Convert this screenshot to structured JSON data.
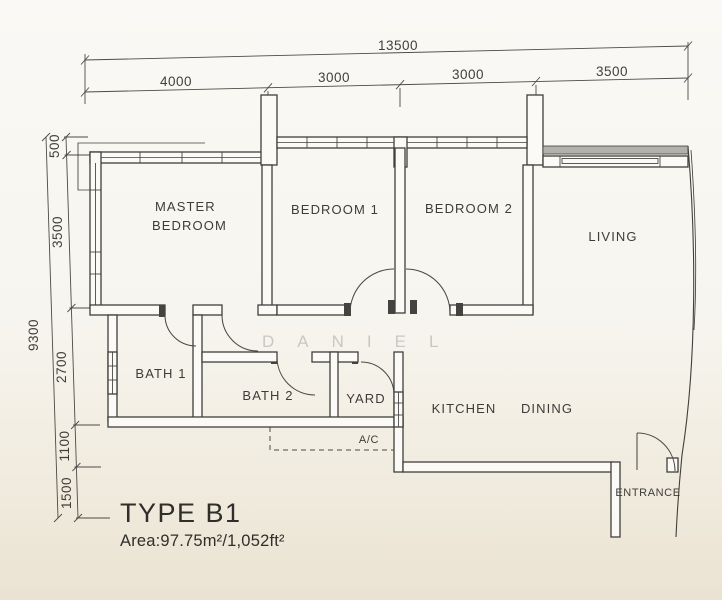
{
  "title_block": {
    "type_label": "TYPE B1",
    "area_label": "Area:97.75m²/1,052ft²"
  },
  "watermark": {
    "text": "DANIEL"
  },
  "rooms": {
    "master_line1": "MASTER",
    "master_line2": "BEDROOM",
    "bedroom1": "BEDROOM 1",
    "bedroom2": "BEDROOM 2",
    "living": "LIVING",
    "bath1": "BATH 1",
    "bath2": "BATH 2",
    "yard": "YARD",
    "ac": "A/C",
    "kitchen": "KITCHEN",
    "dining": "DINING",
    "entrance": "ENTRANCE"
  },
  "dims": {
    "top_total": "13500",
    "top_segments": [
      "4000",
      "3000",
      "3000",
      "3500"
    ],
    "left_total": "9300",
    "left_segments": [
      "500",
      "3500",
      "2700",
      "1100",
      "1500"
    ]
  },
  "colors": {
    "paper": "#f7f5ef",
    "paper_bottom": "#eae2d2",
    "line": "#403f3b",
    "watermark": "#c9c8c4",
    "window_hatch": "#b3b1ab"
  }
}
